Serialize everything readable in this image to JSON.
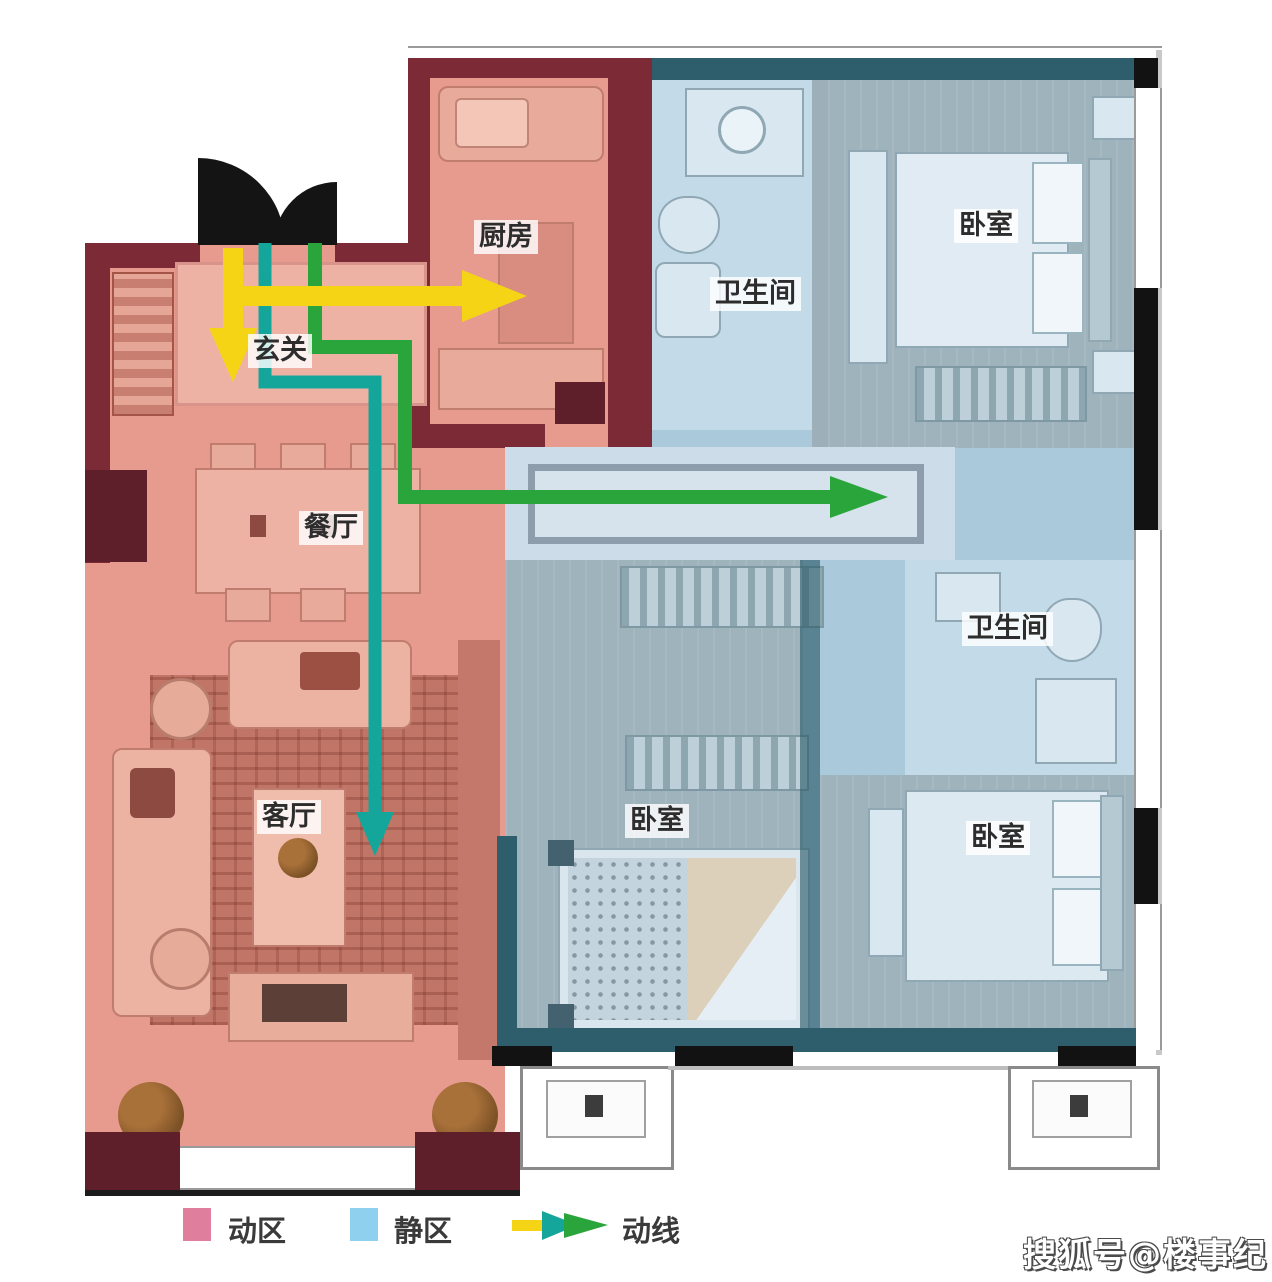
{
  "rooms": {
    "entry": "玄关",
    "kitchen": "厨房",
    "dining": "餐厅",
    "living": "客厅",
    "bathroom": "卫生间",
    "bedroom": "卧室"
  },
  "legend": {
    "active_label": "动区",
    "quiet_label": "静区",
    "flow_label": "动线",
    "active_color": "#df7f9d",
    "quiet_color": "#8fd0ee"
  },
  "flow_colors": {
    "yellow": "#f4d414",
    "teal": "#15a69b",
    "green": "#2aa53b"
  },
  "zone_colors": {
    "active_fill": "#e79b8f",
    "quiet_fill": "#aac9db",
    "active_wall": "#7c2a35",
    "quiet_wall": "#2e5d6c"
  },
  "watermark": "搜狐号@楼事纪"
}
